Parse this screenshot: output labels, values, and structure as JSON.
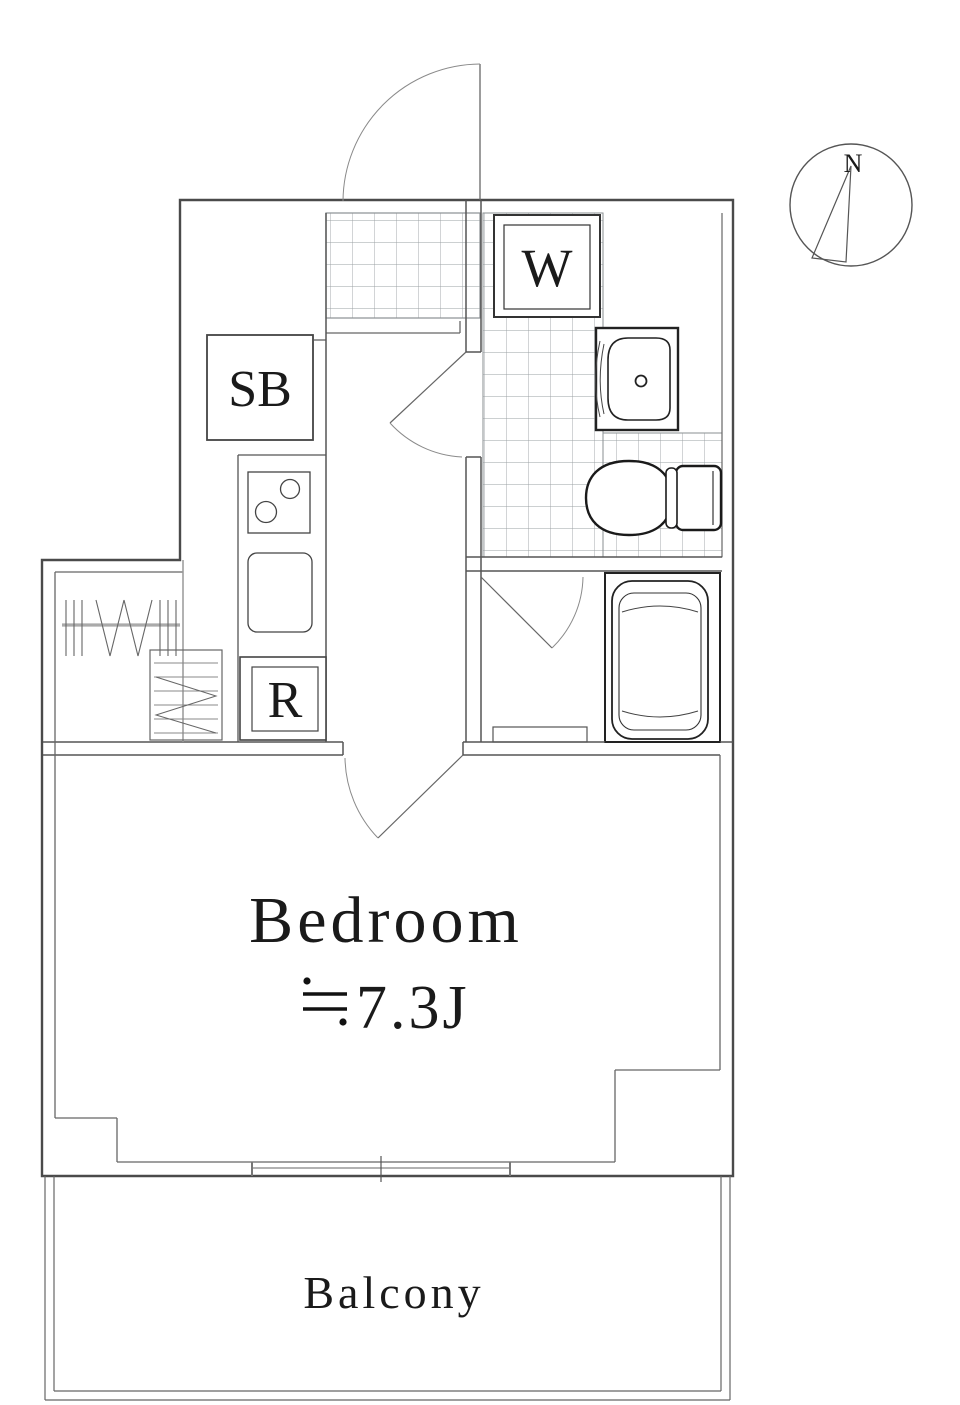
{
  "document_type": "apartment-floor-plan",
  "colors": {
    "background": "#ffffff",
    "wall": "#4a4a4a",
    "line": "#666666",
    "tile_grid": "#9aa0a3",
    "text": "#1a1a1a"
  },
  "compass": {
    "north_label": "N"
  },
  "labels": {
    "washing_machine": "W",
    "shoe_box": "SB",
    "refrigerator": "R"
  },
  "rooms": {
    "bedroom": {
      "name": "Bedroom",
      "area_label": "≒7.3J",
      "area_value": "7.3J"
    },
    "balcony": {
      "name": "Balcony"
    }
  },
  "fixtures": [
    "entry-door-swing",
    "genkan-tile-floor",
    "washroom-tile-floor",
    "washer-pan",
    "vanity-sink",
    "toilet",
    "bathtub",
    "bath-door-swing",
    "washroom-door-swing",
    "bedroom-door-swing",
    "kitchen-stove",
    "kitchen-sink",
    "hanger-rod-closet",
    "shelf-unit",
    "sliding-window"
  ]
}
